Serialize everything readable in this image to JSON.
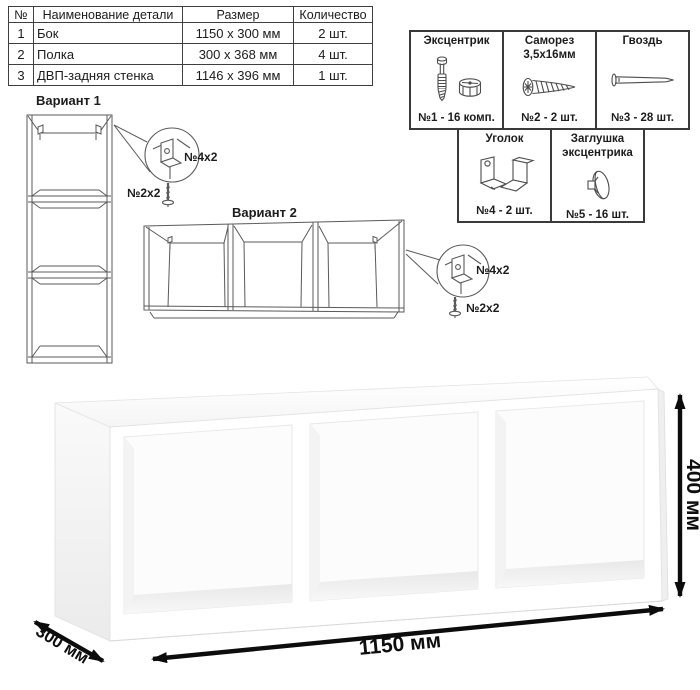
{
  "parts_table": {
    "headers": {
      "num": "№",
      "name": "Наименование детали",
      "size": "Размер",
      "qty": "Количество"
    },
    "rows": [
      {
        "num": "1",
        "name": "Бок",
        "size": "1150 х 300 мм",
        "qty": "2 шт."
      },
      {
        "num": "2",
        "name": "Полка",
        "size": "300 х 368 мм",
        "qty": "4 шт."
      },
      {
        "num": "3",
        "name": "ДВП-задняя стенка",
        "size": "1146 х 396 мм",
        "qty": "1 шт."
      }
    ]
  },
  "hardware": {
    "items": [
      {
        "title": "Эксцентрик",
        "subtitle": "",
        "count": "№1 - 16 комп.",
        "icon": "eccentric-cam-bolt-icon"
      },
      {
        "title": "Саморез",
        "subtitle": "3,5х16мм",
        "count": "№2 - 2 шт.",
        "icon": "screw-icon"
      },
      {
        "title": "Гвоздь",
        "subtitle": "",
        "count": "№3 - 28 шт.",
        "icon": "nail-icon"
      },
      {
        "title": "Уголок",
        "subtitle": "",
        "count": "№4 - 2 шт.",
        "icon": "corner-bracket-icon"
      },
      {
        "title": "Заглушка",
        "subtitle": "эксцентрика",
        "count": "№5 - 16 шт.",
        "icon": "cam-cap-icon"
      }
    ]
  },
  "variants": {
    "variant1": {
      "title": "Вариант 1",
      "bracket_label": "№4х2",
      "screw_label": "№2х2"
    },
    "variant2": {
      "title": "Вариант 2",
      "bracket_label": "№4х2",
      "screw_label": "№2х2"
    }
  },
  "dimensions": {
    "width": "1150 мм",
    "depth": "300 мм",
    "height": "400 мм"
  },
  "colors": {
    "line": "#5a5a5a",
    "dimension": "#0d0d0d",
    "cell_border": "#3a3a3a"
  }
}
